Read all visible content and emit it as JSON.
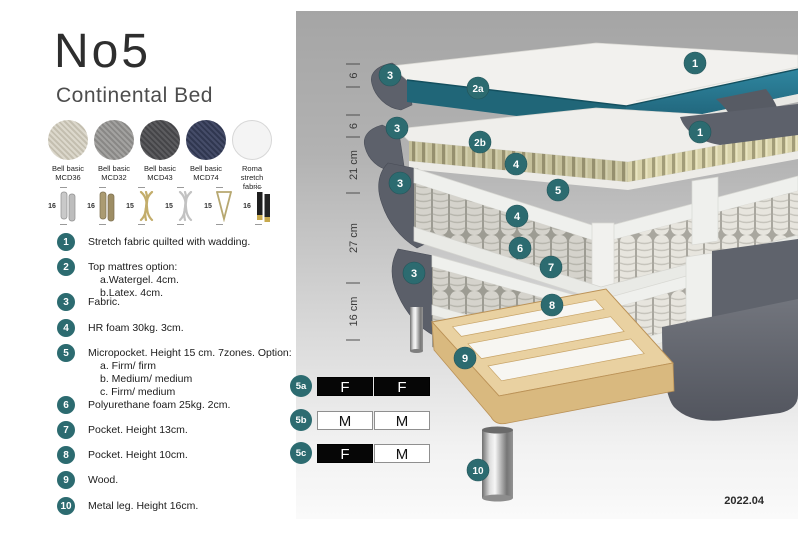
{
  "header": {
    "title": "No5",
    "subtitle": "Continental Bed"
  },
  "fabrics": [
    {
      "name": "Bell basic",
      "code": "MCD36",
      "c1": "#dcd8cc",
      "c2": "#c4bfb0",
      "flat": false
    },
    {
      "name": "Bell basic",
      "code": "MCD32",
      "c1": "#a3a2a0",
      "c2": "#898886",
      "flat": false
    },
    {
      "name": "Bell basic",
      "code": "MCD43",
      "c1": "#5c5c5f",
      "c2": "#454548",
      "flat": false
    },
    {
      "name": "Bell basic",
      "code": "MCD74",
      "c1": "#454c68",
      "c2": "#303750",
      "flat": false
    },
    {
      "name": "Roma",
      "code": "stretch fabric",
      "c1": "#f4f4f4",
      "c2": "#f4f4f4",
      "flat": true
    }
  ],
  "legs": [
    {
      "height": "16",
      "type": "cyl-silver"
    },
    {
      "height": "16",
      "type": "cyl-bronze"
    },
    {
      "height": "15",
      "type": "twist-gold"
    },
    {
      "height": "15",
      "type": "twist-silver"
    },
    {
      "height": "15",
      "type": "hairpin-gold"
    },
    {
      "height": "16",
      "type": "cyl-black-gold"
    }
  ],
  "legend": [
    {
      "num": "1",
      "text": "Stretch fabric quilted with wadding.",
      "sub": []
    },
    {
      "num": "2",
      "text": "Top mattres option:",
      "sub": [
        "a.Watergel. 4cm.",
        "b.Latex. 4cm."
      ]
    },
    {
      "num": "3",
      "text": "Fabric.",
      "sub": []
    },
    {
      "num": "4",
      "text": "HR foam 30kg. 3cm.",
      "sub": []
    },
    {
      "num": "5",
      "text": "Micropocket. Height 15 cm. 7zones. Option:",
      "sub": [
        "a. Firm/ firm",
        "b. Medium/ medium",
        "c. Firm/ medium"
      ]
    },
    {
      "num": "6",
      "text": "Polyurethane foam 25kg. 2cm.",
      "sub": []
    },
    {
      "num": "7",
      "text": "Pocket. Height 13cm.",
      "sub": []
    },
    {
      "num": "8",
      "text": "Pocket. Height 10cm.",
      "sub": []
    },
    {
      "num": "9",
      "text": "Wood.",
      "sub": []
    },
    {
      "num": "10",
      "text": "Metal leg. Height 16cm.",
      "sub": []
    }
  ],
  "diagram": {
    "ruler_labels": [
      "6",
      "6",
      "21 cm",
      "27 cm",
      "16 cm"
    ],
    "callouts": [
      {
        "label": "3",
        "x": 94,
        "y": 64
      },
      {
        "label": "1",
        "x": 399,
        "y": 52
      },
      {
        "label": "2a",
        "x": 182,
        "y": 77
      },
      {
        "label": "3",
        "x": 101,
        "y": 117
      },
      {
        "label": "1",
        "x": 404,
        "y": 121
      },
      {
        "label": "2b",
        "x": 184,
        "y": 131
      },
      {
        "label": "4",
        "x": 220,
        "y": 153
      },
      {
        "label": "5",
        "x": 262,
        "y": 179
      },
      {
        "label": "4",
        "x": 221,
        "y": 205
      },
      {
        "label": "3",
        "x": 104,
        "y": 172
      },
      {
        "label": "6",
        "x": 224,
        "y": 237
      },
      {
        "label": "7",
        "x": 255,
        "y": 256
      },
      {
        "label": "8",
        "x": 256,
        "y": 294
      },
      {
        "label": "3",
        "x": 118,
        "y": 262
      },
      {
        "label": "9",
        "x": 169,
        "y": 347
      },
      {
        "label": "10",
        "x": 182,
        "y": 459
      }
    ],
    "firmness": [
      {
        "label": "5a",
        "cells": [
          {
            "text": "F",
            "variant": "dark"
          },
          {
            "text": "F",
            "variant": "dark"
          }
        ]
      },
      {
        "label": "5b",
        "cells": [
          {
            "text": "M",
            "variant": "light"
          },
          {
            "text": "M",
            "variant": "light"
          }
        ]
      },
      {
        "label": "5c",
        "cells": [
          {
            "text": "F",
            "variant": "dark"
          },
          {
            "text": "M",
            "variant": "light"
          }
        ]
      }
    ],
    "date": "2022.04"
  },
  "colors": {
    "accent_teal": "#2c6b70",
    "watergel_teal": "#2b7e91",
    "latex_tan": "#d9d3ab",
    "fabric_dark_gray": "#5d616b",
    "wood": "#e9d1a1"
  }
}
